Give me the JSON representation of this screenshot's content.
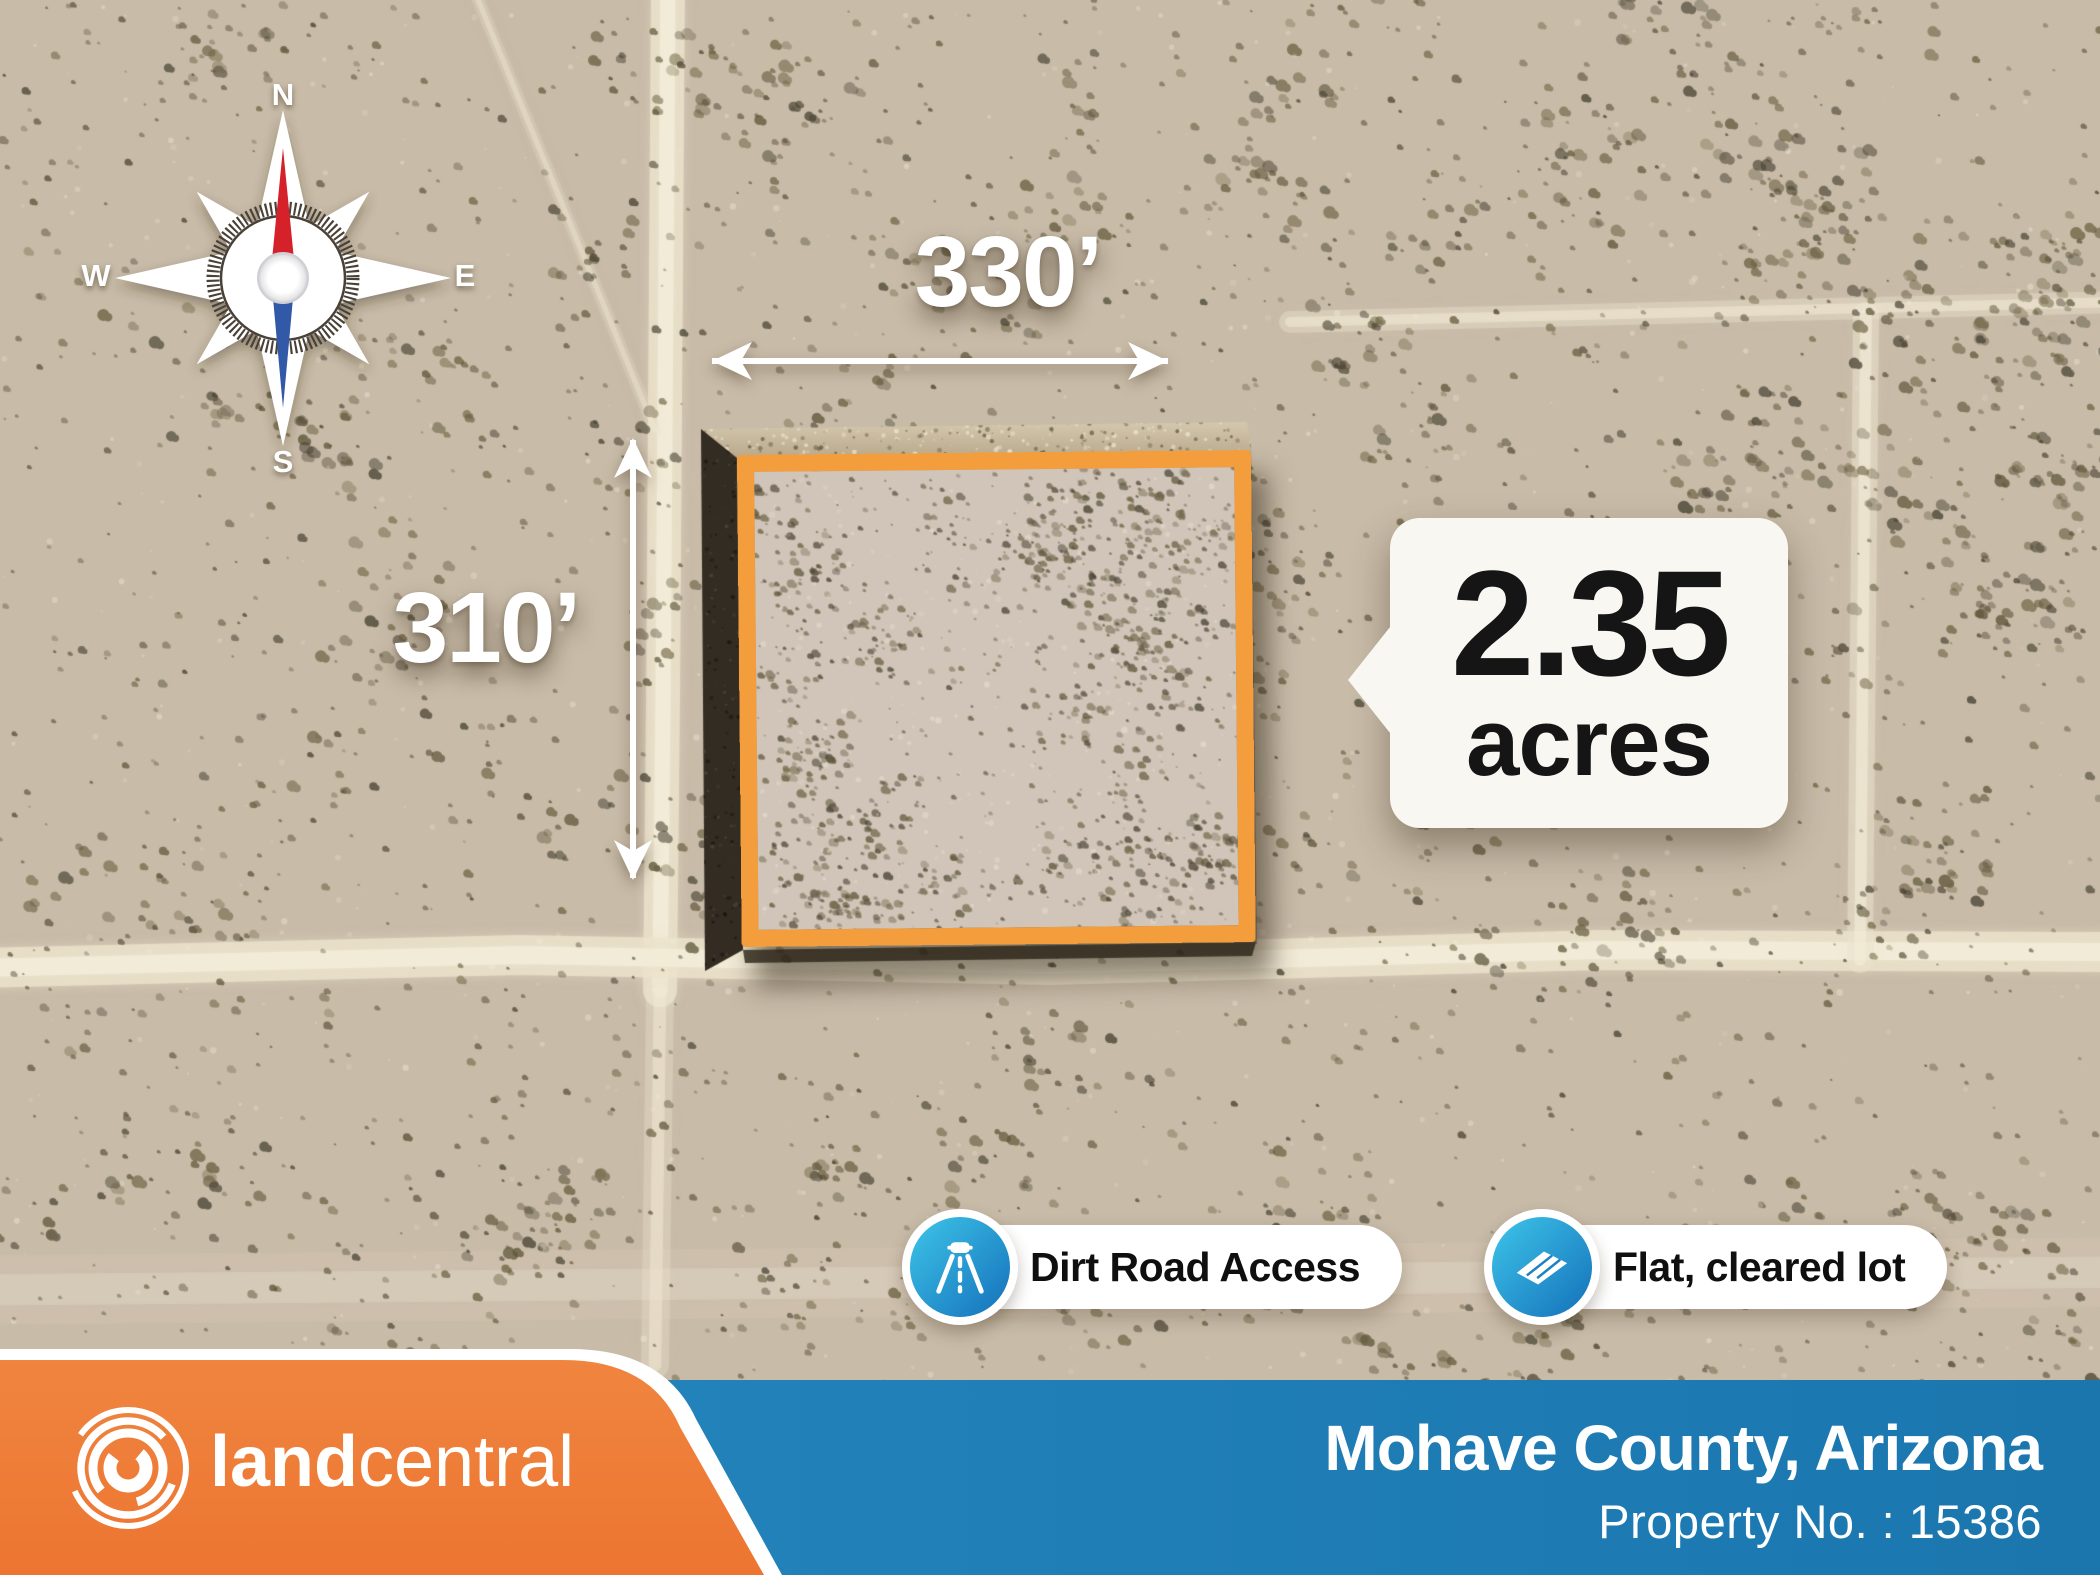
{
  "compass": {
    "north": "N",
    "east": "E",
    "south": "S",
    "west": "W"
  },
  "dimensions": {
    "width": "330’",
    "height": "310’"
  },
  "parcel": {
    "acreage": "2.35",
    "unit": "acres"
  },
  "features": [
    {
      "icon": "dirt-road-icon",
      "label": "Dirt Road Access"
    },
    {
      "icon": "flat-lot-icon",
      "label": "Flat, cleared lot"
    }
  ],
  "footer": {
    "logo_icon": "landcentral-swirl-icon",
    "brand_bold": "land",
    "brand_light": "central",
    "location": "Mohave County, Arizona",
    "property_number": "Property No. : 15386"
  },
  "colors": {
    "boundary_orange": "#f49d3d",
    "footer_orange": "#ee7c3a",
    "footer_blue": "#1e7cb4",
    "badge_gradient_start": "#3ec5e9",
    "badge_gradient_end": "#1470ba"
  }
}
